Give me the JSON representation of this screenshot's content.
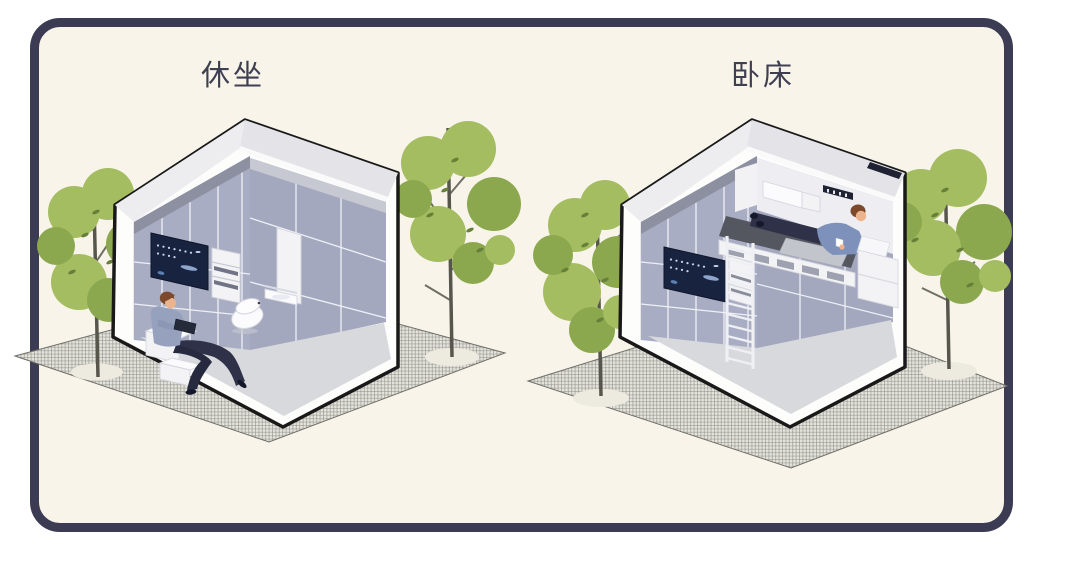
{
  "panels": [
    {
      "id": "sitting-mode",
      "label": "休坐"
    },
    {
      "id": "bed-mode",
      "label": "卧床"
    }
  ],
  "colors": {
    "frame": "#3b3b54",
    "canvas": "#f8f4e9",
    "outer": "#ffffff",
    "ink": "#3f3f52",
    "outline": "#191919",
    "wall": "#fdfdfc",
    "roof": "#e3e3e8",
    "chamfer": "#ededf0",
    "tile": "#a9adc3",
    "tile2": "#a4a8bf",
    "band": "#8d90a0",
    "band2": "#c6c8d2",
    "seam": "#eef0f6",
    "floor": "#d8d9dd",
    "screenbg": "#18233f",
    "sdot": "#c8d4ea",
    "sstreak": "#8fa6cc",
    "sblob": "#5d80b2",
    "wobj": "#f3f3f5",
    "wobj2": "#fbfbfd",
    "ostroke": "#d5d7de",
    "gfill": "#e4e3dc",
    "gline": "#8b8b85",
    "gstroke": "#6f6f69",
    "gbase": "#edebdf",
    "foliage": "#a3bd60",
    "foliage2": "#8ba84e",
    "leaf": "#66803a",
    "trunk": "#57564c",
    "skin": "#ecb48e",
    "hair": "#7c4a2b",
    "shirt": "#96a1bd",
    "shirt2": "#7e91ba",
    "pants": "#2e3148",
    "shoe": "#15182a",
    "mattress": "#54575f",
    "blanket": "#c3c5cc",
    "slot": "#9ea1b0",
    "darkstrip": "#1e2232"
  }
}
